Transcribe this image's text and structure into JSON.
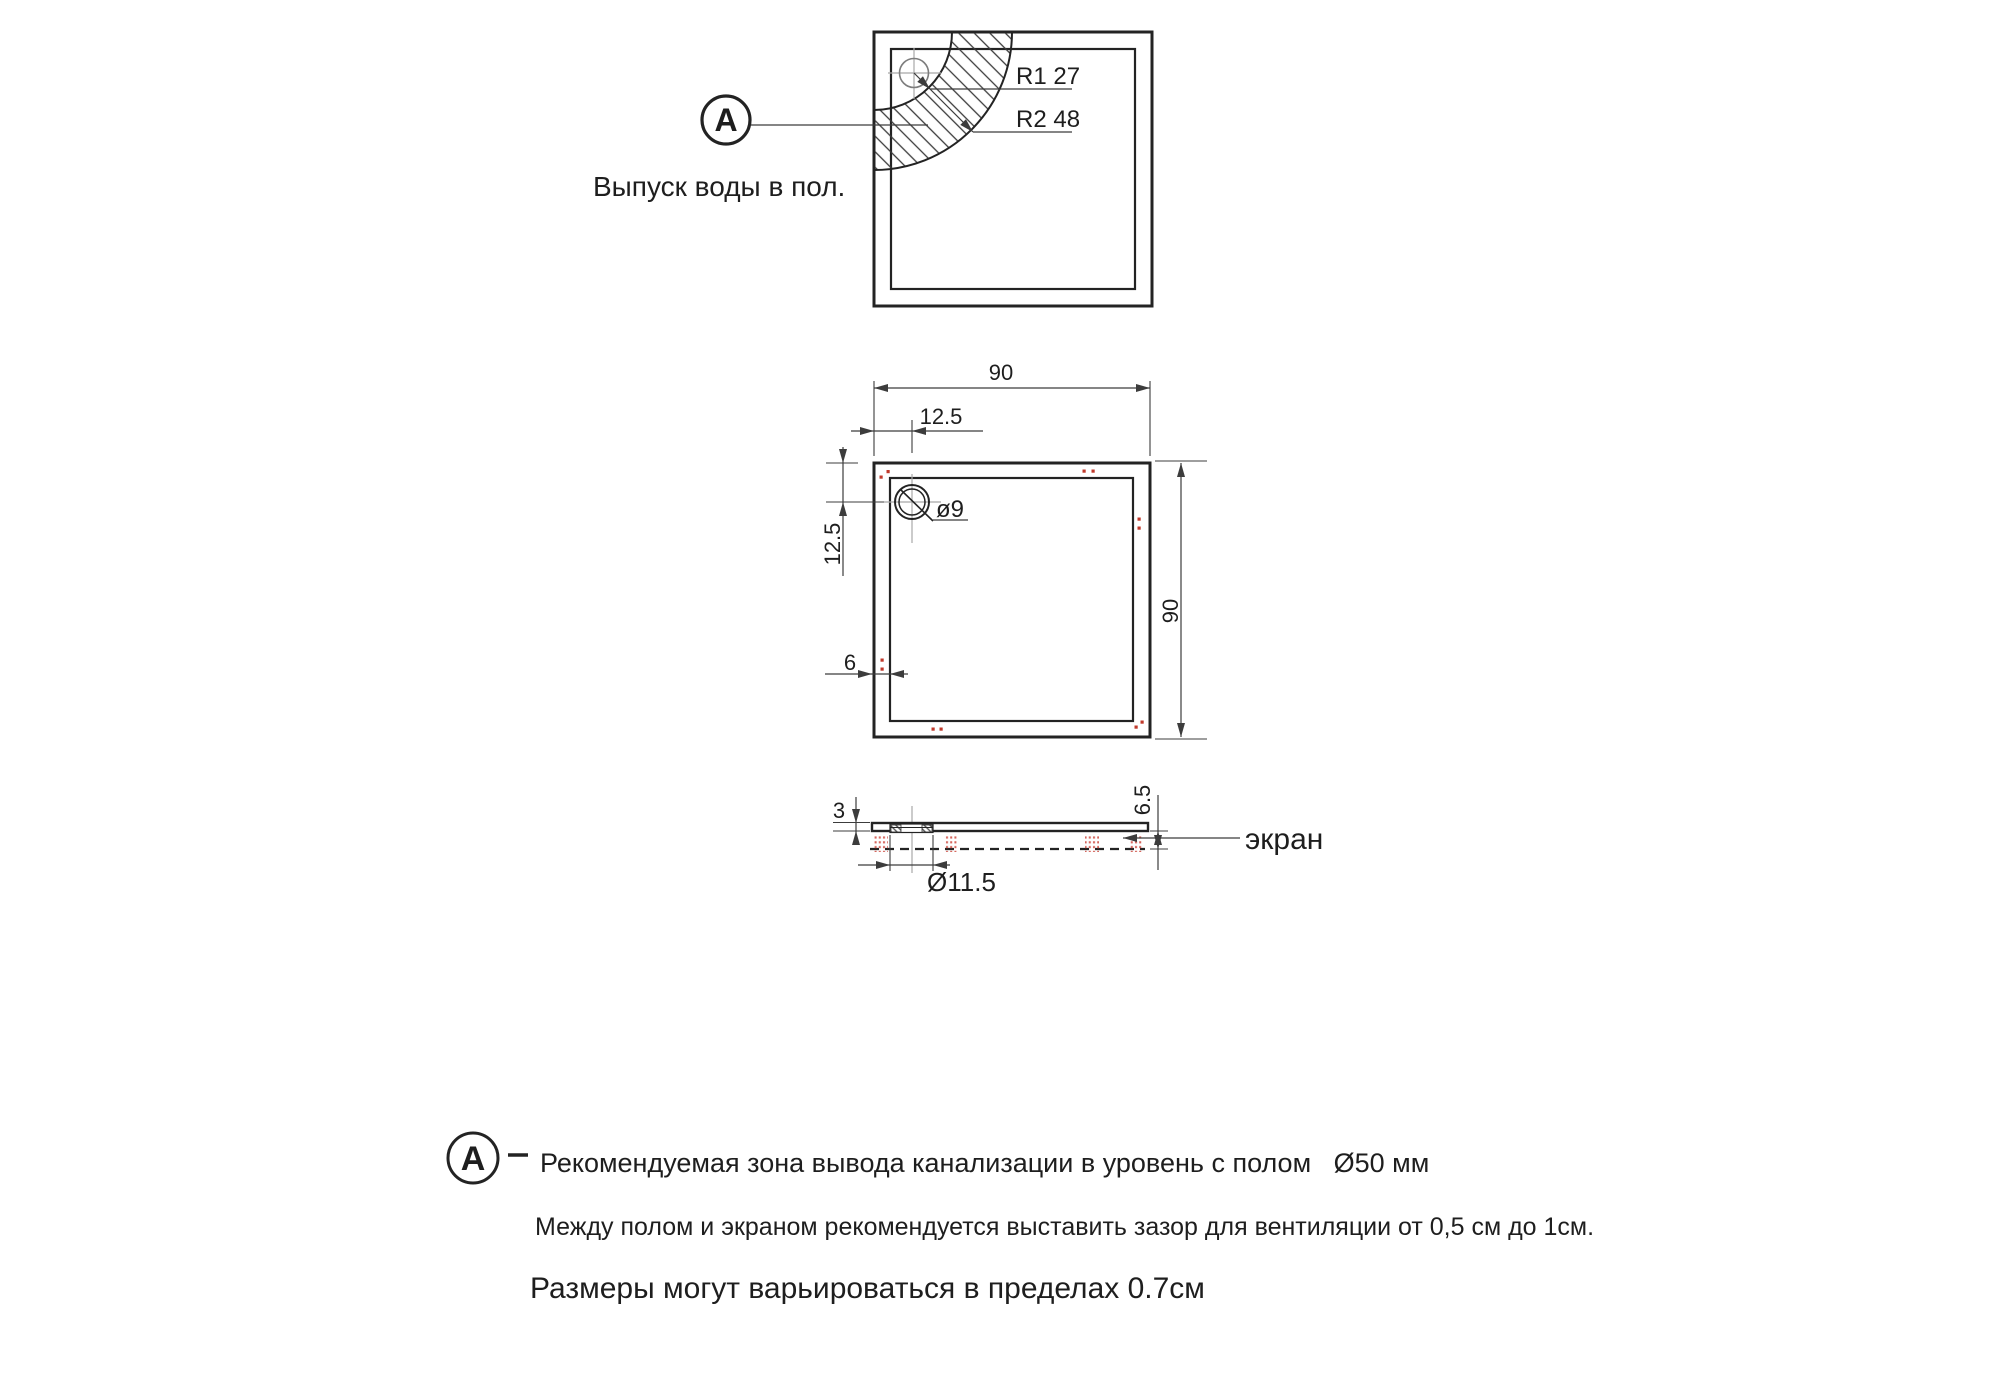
{
  "colors": {
    "line": "#232323",
    "dim": "#3c3c3c",
    "center": "#a8a8a8",
    "red": "#c0392b",
    "text": "#1e1e1e",
    "bg": "#ffffff"
  },
  "top_view": {
    "callout_label": "A",
    "caption": "Выпуск воды в пол.",
    "r1_label": "R1 27",
    "r2_label": "R2 48"
  },
  "plan_view": {
    "width_label": "90",
    "height_label": "90",
    "drain_offset_x_label": "12.5",
    "drain_offset_y_label": "12.5",
    "wall_thickness_label": "6",
    "drain_diameter_label": "ø9"
  },
  "side_view": {
    "tray_thickness_label": "3",
    "total_height_label": "6.5",
    "drain_hole_label": "Ø11.5",
    "screen_label": "экран"
  },
  "notes": {
    "callout_label": "A",
    "line1": "Рекомендуемая зона вывода канализации в уровень с полом   Ø50 мм",
    "line2": "Между полом и экраном рекомендуется выставить зазор для вентиляции от 0,5 см до 1см.",
    "line3": "Размеры могут варьироваться в пределах 0.7см"
  }
}
